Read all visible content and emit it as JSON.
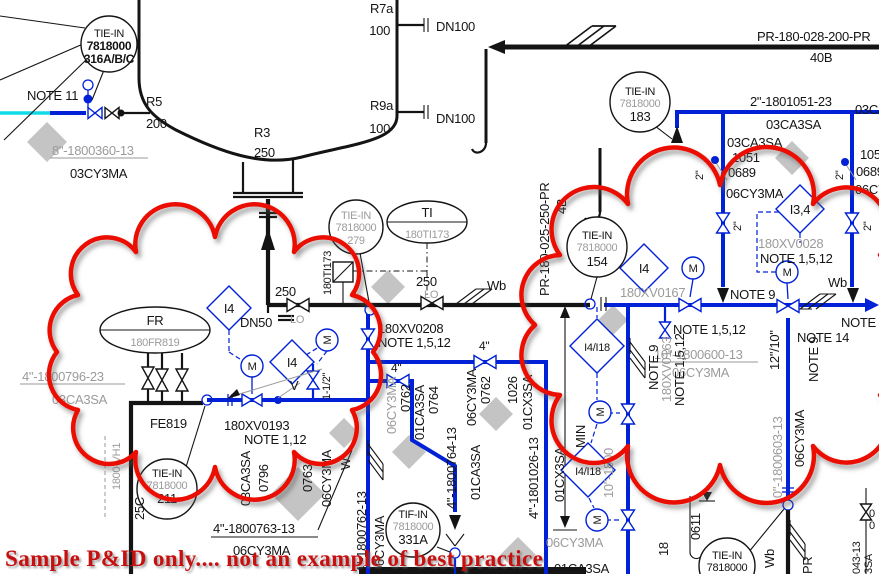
{
  "colors": {
    "pipe_primary_blue": "#0021d6",
    "line_black": "#141414",
    "revision_cloud_red": "#ea0c00",
    "watermark_red": "#c80f0f",
    "utility_cyan": "#10dce8",
    "spec_break_gray": "#c4c4c4",
    "dimmed_text_gray": "#9b9b9b"
  },
  "labels": {
    "tiein": "TIE-IN",
    "tifin": "TIF-IN",
    "n7818": "7818000",
    "n316": "316A/B/C",
    "n183": "183",
    "n154": "154",
    "n279": "279",
    "n211": "211",
    "n331a": "331A",
    "note11": "NOTE 11",
    "note9": "NOTE 9",
    "note14": "NOTE 14",
    "note112": "NOTE 1,12",
    "note1512": "NOTE 1,5,12",
    "r5": "R5",
    "n200": "200",
    "r3": "R3",
    "v250": "250",
    "r7a": "R7a",
    "r9a": "R9a",
    "n100": "100",
    "dn100": "DN100",
    "dn50": "DN50",
    "lo": "LO",
    "pr028": "PR-180-028-200-PR",
    "b40": "40B",
    "pr025": "PR-180-025-250-PR",
    "b4": "4B",
    "ln1051": "2\"-1801051-23",
    "ln360": "8\"-1800360-13",
    "ln796": "4\"-1800796-23",
    "ln763": "4\"-1800763-13",
    "ln762": "4\"-1800762-13",
    "ln764": "4\"-1800764-13",
    "ln1026": "4\"-1801026-13",
    "ln600": "10\"-1800600-13",
    "ln603": "10\"-1800603-13",
    "ln18frag": "10\"-1800",
    "ca03": "03CA3SA",
    "ca01": "01CA3SA",
    "cx01": "01CX3SA",
    "cy03": "03CY3MA",
    "cy06": "06CY3MA",
    "n1051": "1051",
    "n0689": "0689",
    "n0796": "0796",
    "n0763": "0763",
    "n0762": "0762",
    "n0764": "0764",
    "n1026": "1026",
    "n0611": "0611",
    "n18": "18",
    "n043": "043-13",
    "sa3": "3SA",
    "n0": "0",
    "xv0028": "180XV0028",
    "xv0208": "180XV0208",
    "xv0193": "180XV0193",
    "xv0167": "180XV0167",
    "xv0163": "180XV0163",
    "ti": "TI",
    "ti173": "180TI173",
    "fr": "FR",
    "fr819": "180FR819",
    "fe819": "FE819",
    "i4": "I4",
    "i34": "I3,4",
    "i418": "I4/I18",
    "m": "M",
    "v": "V",
    "in2": "2\"",
    "sz4": "4\"",
    "sz112": "1-1/2\"",
    "sz1210": "12\"/10\"",
    "wb": "Wb",
    "w": "W",
    "pr": "PR",
    "min": "MIN",
    "c25": "25C",
    "vh": "1800-VH1",
    "watermark": "Sample P&ID only.... not an example of best practice"
  }
}
